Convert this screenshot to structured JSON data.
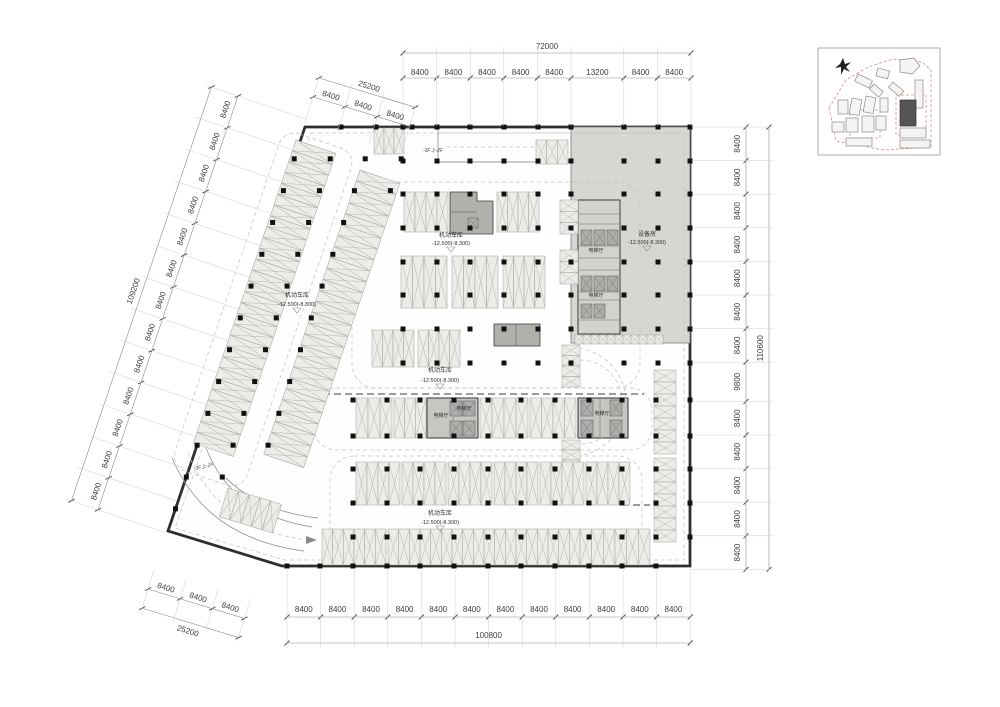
{
  "dims": {
    "top": {
      "total": "72000",
      "segments": [
        "8400",
        "8400",
        "8400",
        "8400",
        "8400",
        "13200",
        "8400",
        "8400"
      ]
    },
    "top_left": {
      "total": "25200",
      "segments": [
        "8400",
        "8400",
        "8400"
      ]
    },
    "left": {
      "total": "109200",
      "segments": [
        "8400",
        "8400",
        "8400",
        "8400",
        "8400",
        "8400",
        "8400",
        "8400",
        "8400",
        "8400",
        "8400",
        "8400",
        "8400"
      ]
    },
    "right": {
      "total": "110600",
      "segments": [
        "8400",
        "8400",
        "8400",
        "8400",
        "8400",
        "8400",
        "8400",
        "9800",
        "8400",
        "8400",
        "8400",
        "8400",
        "8400"
      ]
    },
    "bottom": {
      "total": "100800",
      "segments": [
        "8400",
        "8400",
        "8400",
        "8400",
        "8400",
        "8400",
        "8400",
        "8400",
        "8400",
        "8400",
        "8400",
        "8400"
      ]
    },
    "bottom_left": {
      "total": "25200",
      "segments": [
        "8400",
        "8400",
        "8400"
      ]
    }
  },
  "rooms": {
    "garage": {
      "name": "机动车库",
      "level": "-12.500(-8.300)"
    },
    "equipment": {
      "name": "设备房",
      "level": "-12.500(-8.300)"
    },
    "elevator_hall": {
      "name": "电梯厅"
    }
  },
  "ramp": {
    "label": "-3F上-2F"
  },
  "colors": {
    "wall": "#2e2e2e",
    "equipment_fill": "#d6d6d3",
    "core_fill": "#c6c6c3",
    "room_fill": "#b0b0ad",
    "stall_fill": "#ecece9",
    "dim_text": "#3d3d3d",
    "red_boundary": "#dd8c8c"
  }
}
